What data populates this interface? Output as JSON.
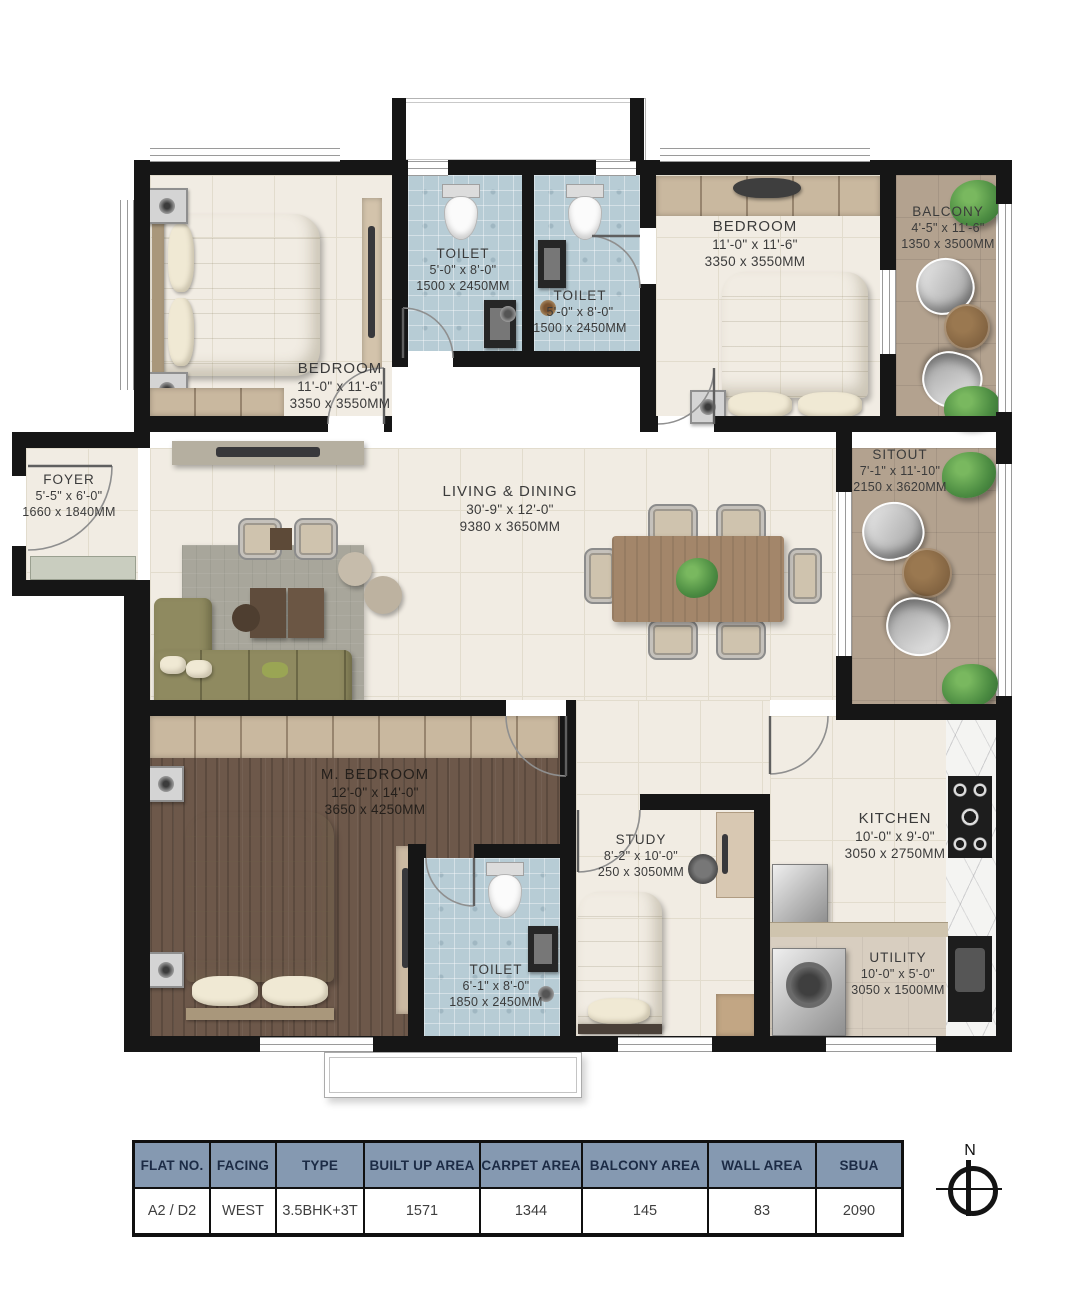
{
  "plan": {
    "rooms": [
      {
        "name": "BEDROOM",
        "dims_ft": "11'-0\" x 11'-6\"",
        "dims_mm": "3350 x 3550MM"
      },
      {
        "name": "TOILET",
        "dims_ft": "5'-0\" x 8'-0\"",
        "dims_mm": "1500 x 2450MM"
      },
      {
        "name": "TOILET",
        "dims_ft": "5'-0\" x 8'-0\"",
        "dims_mm": "1500 x 2450MM"
      },
      {
        "name": "BEDROOM",
        "dims_ft": "11'-0\" x 11'-6\"",
        "dims_mm": "3350 x 3550MM"
      },
      {
        "name": "BALCONY",
        "dims_ft": "4'-5\" x 11'-6\"",
        "dims_mm": "1350 x 3500MM"
      },
      {
        "name": "FOYER",
        "dims_ft": "5'-5\" x 6'-0\"",
        "dims_mm": "1660 x 1840MM"
      },
      {
        "name": "LIVING & DINING",
        "dims_ft": "30'-9\" x 12'-0\"",
        "dims_mm": "9380 x 3650MM"
      },
      {
        "name": "SITOUT",
        "dims_ft": "7'-1\" x 11'-10\"",
        "dims_mm": "2150 x 3620MM"
      },
      {
        "name": "M. BEDROOM",
        "dims_ft": "12'-0\" x 14'-0\"",
        "dims_mm": "3650 x 4250MM"
      },
      {
        "name": "STUDY",
        "dims_ft": "8'-2\" x 10'-0\"",
        "dims_mm": "250 x 3050MM"
      },
      {
        "name": "TOILET",
        "dims_ft": "6'-1\" x 8'-0\"",
        "dims_mm": "1850 x 2450MM"
      },
      {
        "name": "KITCHEN",
        "dims_ft": "10'-0\" x 9'-0\"",
        "dims_mm": "3050 x 2750MM"
      },
      {
        "name": "UTILITY",
        "dims_ft": "10'-0\" x 5'-0\"",
        "dims_mm": "3050 x 1500MM"
      }
    ]
  },
  "summary_table": {
    "headers": [
      "FLAT NO.",
      "FACING",
      "TYPE",
      "BUILT UP AREA",
      "CARPET AREA",
      "BALCONY AREA",
      "WALL AREA",
      "SBUA"
    ],
    "row": [
      "A2 / D2",
      "WEST",
      "3.5BHK+3T",
      "1571",
      "1344",
      "145",
      "83",
      "2090"
    ]
  },
  "compass": {
    "label": "N"
  },
  "colors": {
    "wall": "#161616",
    "table_header_bg": "#8599b1",
    "toilet_tile": "#b7ccd5",
    "balcony_floor": "#b3a28f",
    "wood_floor": "#6d584a",
    "plant_green": "#4c8c42"
  }
}
